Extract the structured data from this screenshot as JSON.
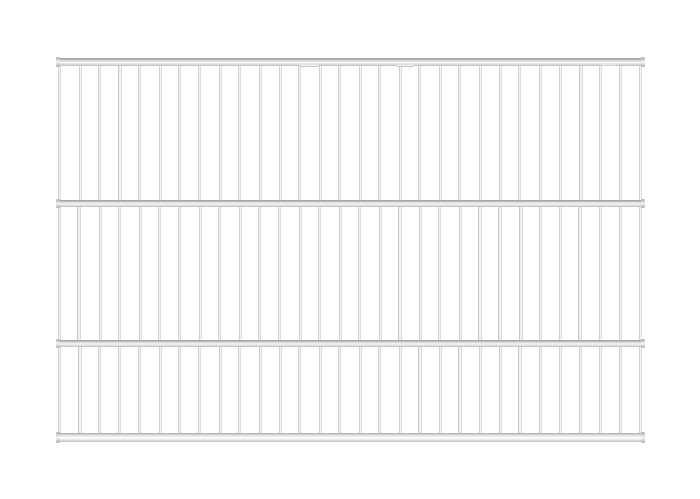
{
  "image": {
    "description": "Product photo of a silver-grey metal wire grid fence panel on a plain white background",
    "subject": "wire-grid-fence-panel",
    "background_color": "#ffffff"
  },
  "colors": {
    "bar_edge_dark": "#b2b2b2",
    "bar_mid": "#e7e7e7",
    "bar_highlight": "#fbfbfb",
    "bar_edge_light": "#c6c6c6",
    "rail_top_line": "#a6a6a6",
    "rail_body": "#dcdcdc",
    "rail_highlight": "#f4f4f4",
    "rail_bottom_line": "#bcbcbc",
    "cap_edge": "#aaaaaa"
  },
  "panel": {
    "left": 56,
    "width": 589,
    "first_bar_x": 58,
    "last_bar_x": 639,
    "bars_per_row": 30,
    "bar_width": 3.2,
    "rails": [
      {
        "y": 58,
        "h": 8,
        "thick": false
      },
      {
        "y": 200,
        "h": 7,
        "thick": false
      },
      {
        "y": 340,
        "h": 7,
        "thick": false
      },
      {
        "y": 433,
        "h": 9,
        "thick": true
      }
    ],
    "rows": [
      {
        "top": 62,
        "bottom": 204
      },
      {
        "top": 205,
        "bottom": 344
      },
      {
        "top": 345,
        "bottom": 437
      }
    ],
    "row_jitter_scale": [
      1,
      -1,
      0.6
    ],
    "jitter": [
      0,
      0.6,
      -0.4,
      0.3,
      -0.6,
      0.5,
      0,
      -0.3,
      0.4,
      -0.5,
      0.2,
      0.6,
      -0.2,
      0.3,
      -0.4,
      0.5,
      -0.6,
      0.2,
      -0.3,
      0.6,
      -0.5,
      0.3,
      0.4,
      -0.6,
      0.2,
      -0.2,
      0.5,
      -0.4,
      0.3,
      0
    ],
    "clips": [
      {
        "x": 299,
        "y": 64,
        "w": 19,
        "h": 3
      },
      {
        "x": 397,
        "y": 64,
        "w": 17,
        "h": 3
      },
      {
        "x": 601,
        "y": 64,
        "w": 14,
        "h": 2
      }
    ]
  }
}
